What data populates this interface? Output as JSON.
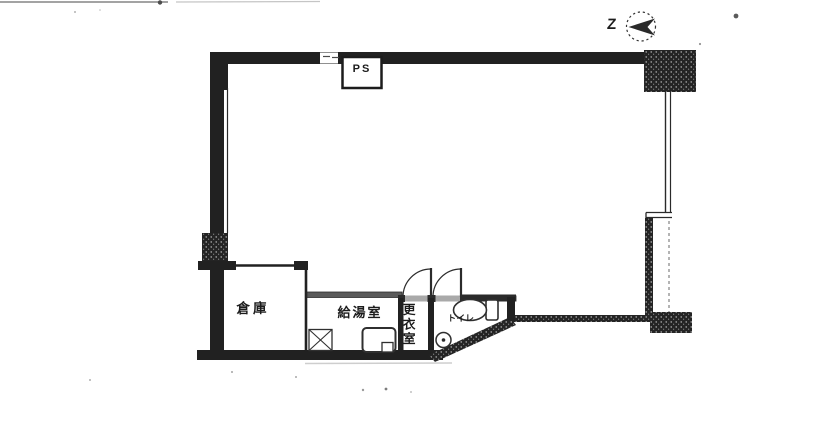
{
  "floor_plan": {
    "labels": {
      "ps": "PS",
      "storage": "倉庫",
      "kitchenette": "給湯室",
      "changing_room": "更衣室",
      "toilet": "トイレ",
      "north_mark": "Z"
    },
    "colors": {
      "wall": "#212121",
      "partition_gray": "#5a5a5a",
      "threshold": "#a0a0a0",
      "ink": "#1c1c1c",
      "paper": "#ffffff"
    }
  }
}
